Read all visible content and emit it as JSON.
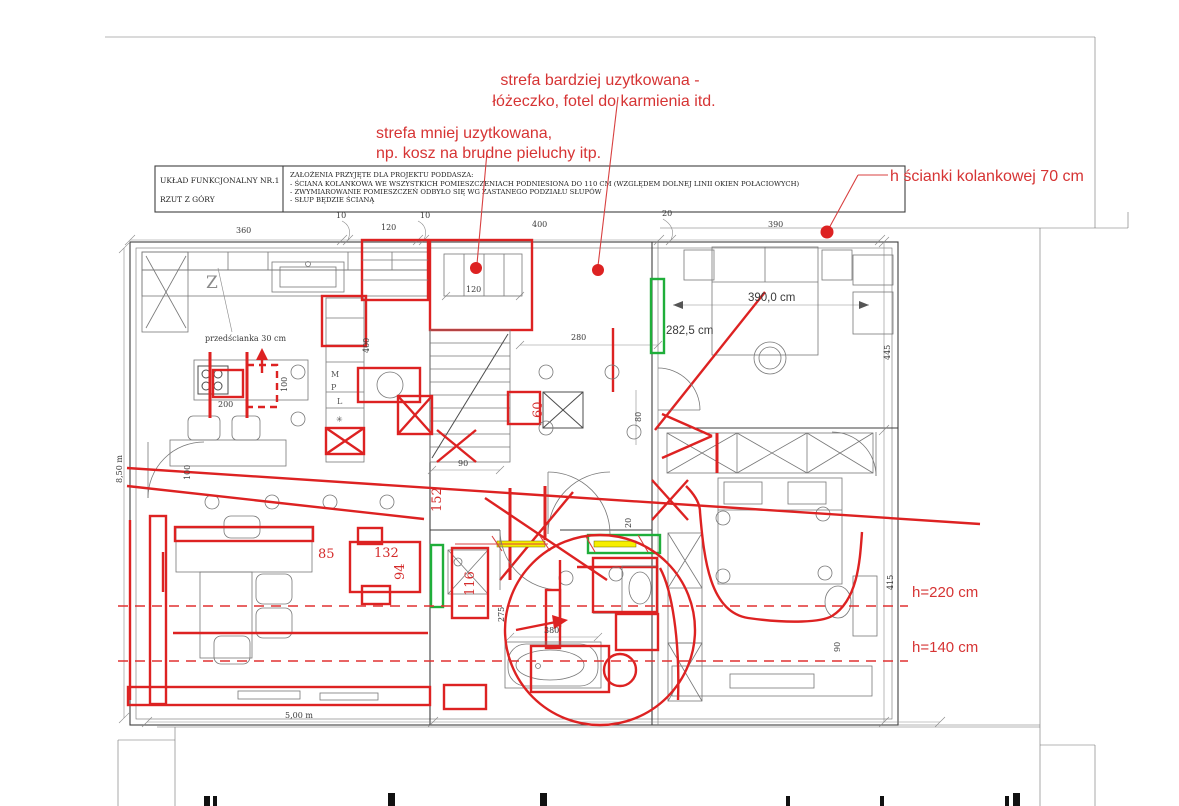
{
  "colors": {
    "annotation_red": "#dd2222",
    "annotation_text_red": "#d63434",
    "highlight_green": "#1fae3a",
    "highlight_yellow": "#f6ee00",
    "drawing_line": "#3f3f3f"
  },
  "annotations": {
    "zone_more_1": "strefa bardziej uzytkowana -",
    "zone_more_2": "łóżeczko, fotel do karmienia itd.",
    "zone_less_1": "strefa mniej uzytkowana,",
    "zone_less_2": "np. kosz na brudne pieluchy itp.",
    "knee_wall": "h ścianki kolankowej 70 cm",
    "h220": "h=220 cm",
    "h140": "h=140 cm",
    "partition": "przedścianka 30 cm"
  },
  "title_block": {
    "name": "UKŁAD FUNKCJONALNY NR.1",
    "view": "RZUT Z GÓRY",
    "assumptions_title": "ZAŁOŻENIA PRZYJĘTE DLA PROJEKTU PODDASZA:",
    "assumption_1": "- ŚCIANA KOLANKOWA WE WSZYSTKICH POMIESZCZENIACH PODNIESIONA DO 110 CM (WZGLĘDEM DOLNEJ LINII OKIEN POŁACIOWYCH)",
    "assumption_2": "- ZWYMIAROWANIE POMIESZCZEŃ ODBYŁO SIĘ WG ZASTANEGO PODZIAŁU SŁUPÓW",
    "assumption_3": "- SŁUP BĘDZIE ŚCIANĄ"
  },
  "dimensions": {
    "top_360": "360",
    "top_10a": "10",
    "top_120": "120",
    "top_10b": "10",
    "top_400": "400",
    "top_20": "20",
    "top_390": "390",
    "kitchen_200": "200",
    "kitchen_100": "100",
    "door_100": "100",
    "wall_400": "400",
    "stairs_90": "90",
    "hall_80": "80",
    "room_280": "280",
    "crib_120": "120",
    "threshold_20": "20",
    "bed_width": "390,0 cm",
    "room_width": "282,5 cm",
    "right_445": "445",
    "right_415": "415",
    "bath_275": "275",
    "bath_380": "380",
    "bedroom_90": "90",
    "left_height": "8,50 m",
    "bottom_width": "5,00 m"
  },
  "red_dimensions": {
    "d152": "152",
    "d60": "60",
    "d85": "85",
    "d132": "132",
    "d94": "94",
    "d116": "116"
  },
  "symbols": {
    "m": "M",
    "p": "P",
    "l": "L",
    "snowflake": "✳",
    "dishwasher": "Z"
  }
}
